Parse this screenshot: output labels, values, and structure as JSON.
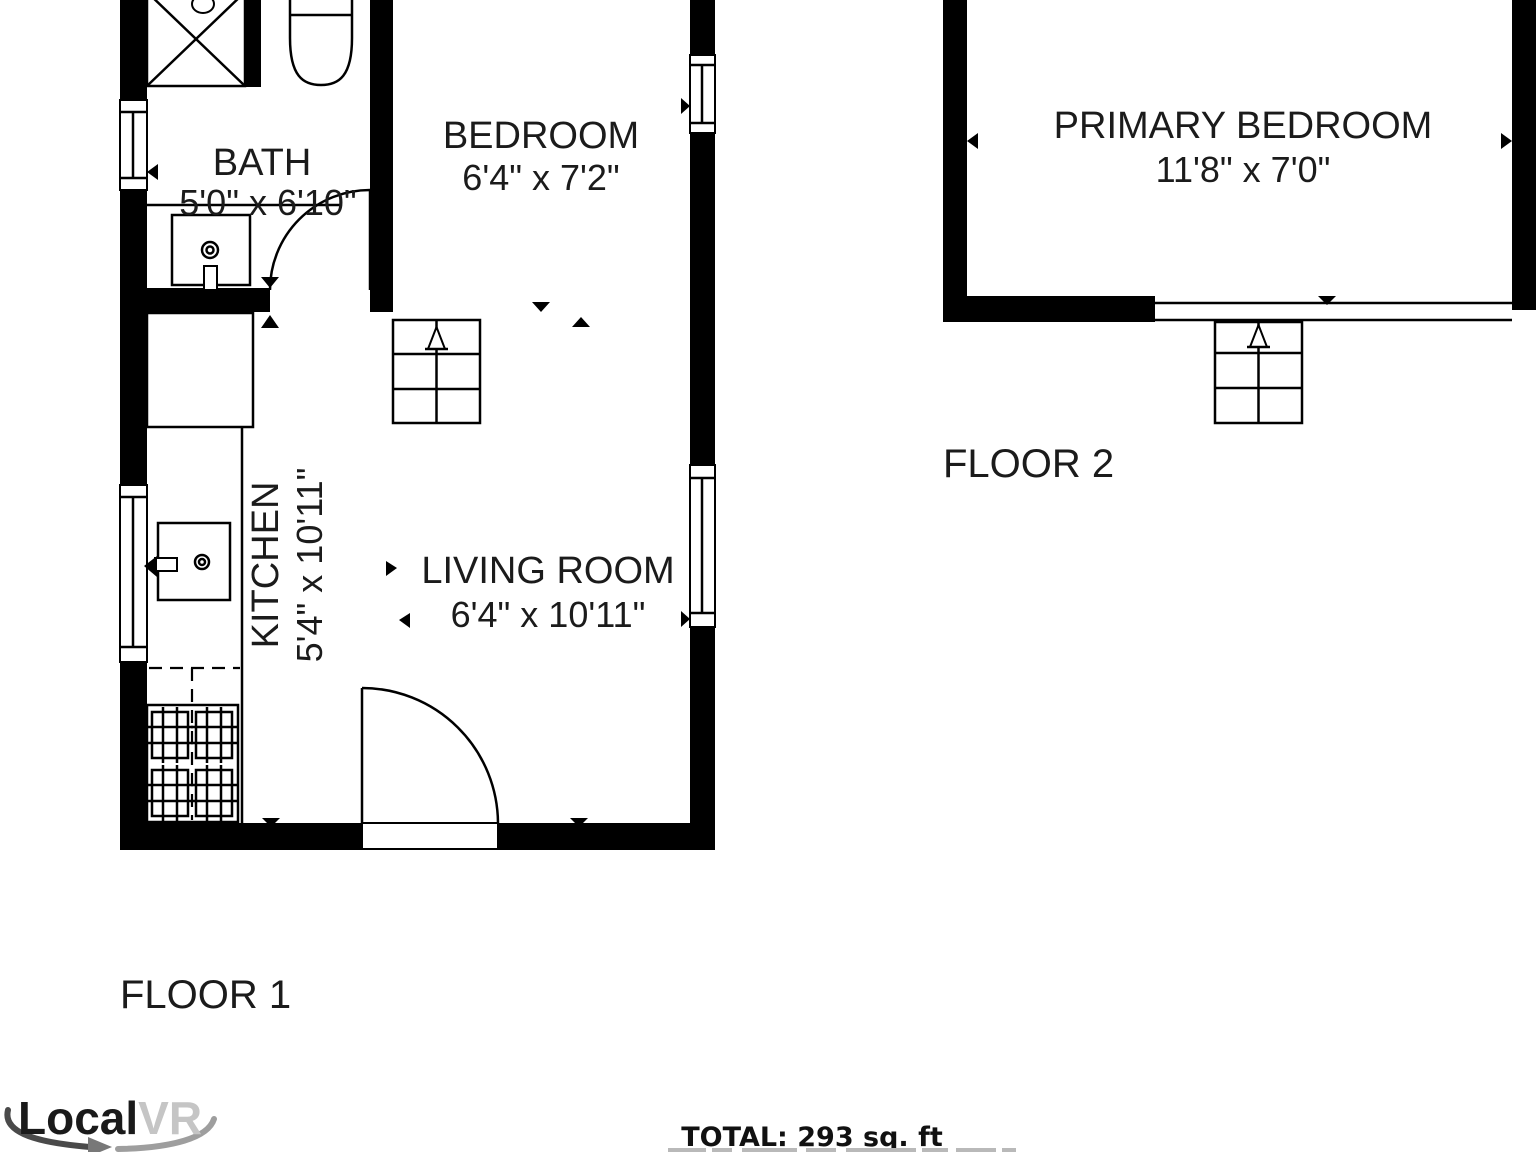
{
  "floor1": {
    "label": "FLOOR 1",
    "bath": {
      "name": "BATH",
      "dims": "5'0\" x 6'10\""
    },
    "bedroom": {
      "name": "BEDROOM",
      "dims": "6'4\" x 7'2\""
    },
    "kitchen": {
      "name": "KITCHEN",
      "dims": "5'4\" x 10'11\""
    },
    "living_room": {
      "name": "LIVING ROOM",
      "dims": "6'4\" x 10'11\""
    }
  },
  "floor2": {
    "label": "FLOOR 2",
    "primary_bedroom": {
      "name": "PRIMARY BEDROOM",
      "dims": "11'8\" x 7'0\""
    }
  },
  "footer": {
    "total": "TOTAL: 293 sq. ft"
  },
  "logo": {
    "primary": "Local",
    "secondary": "VR"
  },
  "colors": {
    "line": "#000000",
    "text": "#1b1b1b",
    "logo_secondary": "#c5c5c5",
    "swoosh_dark": "#4a4a4a",
    "swoosh_light": "#9e9e9e"
  }
}
